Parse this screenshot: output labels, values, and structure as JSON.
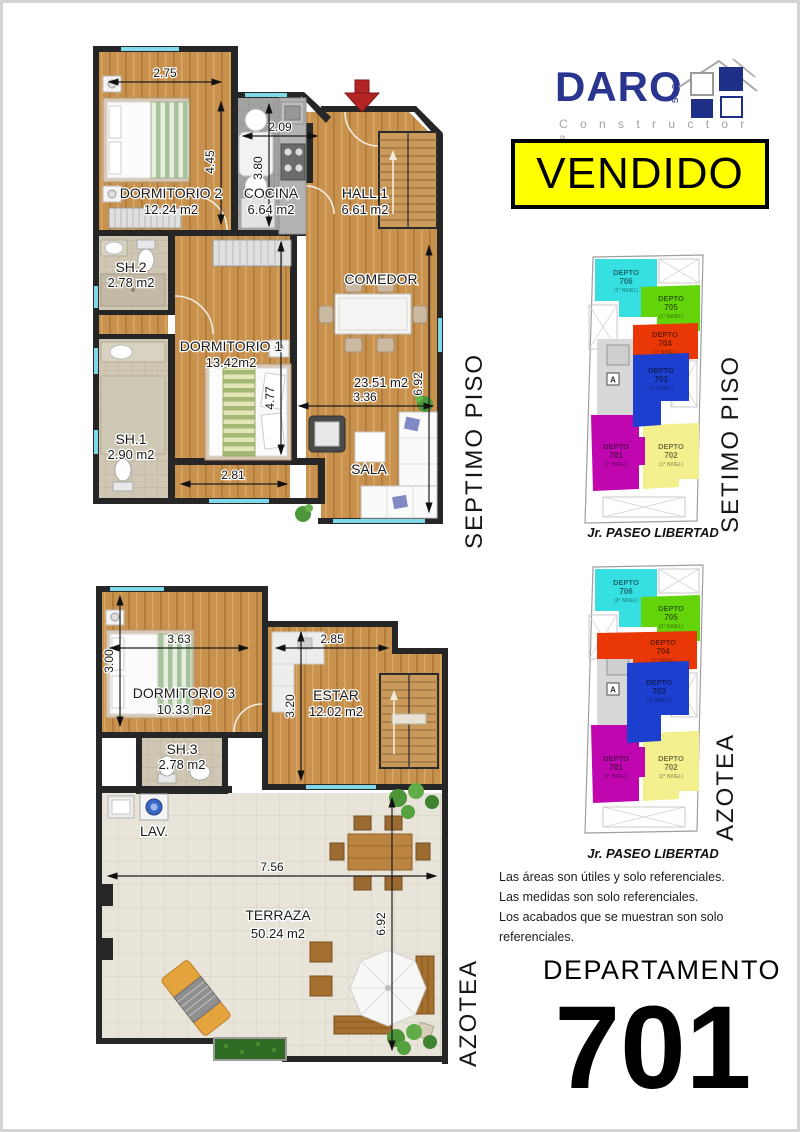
{
  "logo": {
    "brand": "DARO",
    "suffix": "sac",
    "tagline": "C o n s t r u c t o r a",
    "brand_color": "#2a3590",
    "tagline_color": "#a3a3a3"
  },
  "banner": {
    "label": "VENDIDO",
    "bg_color": "#ffff00",
    "text_color": "#000000"
  },
  "colors": {
    "wall": "#262626",
    "wood": "#c8914d",
    "kitchen_tile": "#a2a2a2",
    "bath_tile": "#cfc7b3",
    "terrace_tile": "#e9e4d9",
    "window": "#7fd9ea",
    "entry_arrow": "#b32525"
  },
  "plan7": {
    "side_label": "SEPTIMO PISO",
    "rooms": {
      "dorm2": {
        "name": "DORMITORIO 2",
        "area": "12.24 m2"
      },
      "cocina": {
        "name": "COCINA",
        "area": "6.64 m2"
      },
      "hall": {
        "name": "HALL 1",
        "area": "6.61 m2"
      },
      "sh2": {
        "name": "SH.2",
        "area": "2.78 m2"
      },
      "dorm1": {
        "name": "DORMITORIO 1",
        "area": "13.42m2"
      },
      "sh1": {
        "name": "SH.1",
        "area": "2.90 m2"
      },
      "comedor": {
        "name": "COMEDOR"
      },
      "sala": {
        "name": "SALA"
      },
      "social_area": "23.51 m2"
    },
    "dims": {
      "w_dorm2": "2.75",
      "h_dorm2": "4.45",
      "w_cocina": "2.09",
      "h_cocina": "3.80",
      "h_social": "6.92",
      "w_sala": "3.36",
      "h_dorm1": "4.77",
      "w_dorm1": "2.81"
    }
  },
  "planA": {
    "side_label": "AZOTEA",
    "rooms": {
      "dorm3": {
        "name": "DORMITORIO 3",
        "area": "10.33 m2"
      },
      "estar": {
        "name": "ESTAR",
        "area": "12.02 m2"
      },
      "sh3": {
        "name": "SH.3",
        "area": "2.78 m2"
      },
      "lav": {
        "name": "LAV."
      },
      "terraza": {
        "name": "TERRAZA",
        "area": "50.24 m2"
      }
    },
    "dims": {
      "w_dorm3": "3.63",
      "h_dorm3": "3.00",
      "w_estar": "2.85",
      "h_estar": "3.20",
      "w_terraza": "7.56",
      "h_terraza": "6.92"
    }
  },
  "key7": {
    "side_label": "SETIMO PISO",
    "street": "Jr. PASEO LIBERTAD",
    "elevator_label": "A",
    "units": [
      {
        "name": "DEPTO",
        "num": "706",
        "level": "(1° NIVEL)",
        "color": "#35dfe2"
      },
      {
        "name": "DEPTO",
        "num": "705",
        "level": "(1° NIVEL)",
        "color": "#63d409"
      },
      {
        "name": "DEPTO",
        "num": "704",
        "level": "(1° NIVEL)",
        "color": "#e93806"
      },
      {
        "name": "DEPTO",
        "num": "703",
        "level": "(1° NIVEL)",
        "color": "#1c3fd0"
      },
      {
        "name": "DEPTO",
        "num": "701",
        "level": "(1° NIVEL)",
        "color": "#bf06af"
      },
      {
        "name": "DEPTO",
        "num": "702",
        "level": "(1° NIVEL)",
        "color": "#f4f08e"
      }
    ]
  },
  "keyA": {
    "side_label": "AZOTEA",
    "street": "Jr. PASEO LIBERTAD",
    "elevator_label": "A",
    "units": [
      {
        "name": "DEPTO",
        "num": "706",
        "level": "(2° NIVEL)",
        "color": "#35dfe2"
      },
      {
        "name": "DEPTO",
        "num": "705",
        "level": "(2° NIVEL)",
        "color": "#63d409"
      },
      {
        "name": "DEPTO",
        "num": "704",
        "level": "(2° NIVEL)",
        "color": "#e93806"
      },
      {
        "name": "DEPTO",
        "num": "703",
        "level": "(2° NIVEL)",
        "color": "#1c3fd0"
      },
      {
        "name": "DEPTO",
        "num": "701",
        "level": "(2° NIVEL)",
        "color": "#bf06af"
      },
      {
        "name": "DEPTO",
        "num": "702",
        "level": "(2° NIVEL)",
        "color": "#f4f08e"
      }
    ]
  },
  "footer": {
    "disclaimers": [
      "Las áreas son útiles y solo referenciales.",
      "Las medidas son solo referenciales.",
      "Los acabados que se muestran son solo referenciales."
    ],
    "dept_label": "DEPARTAMENTO",
    "dept_number": "701"
  }
}
